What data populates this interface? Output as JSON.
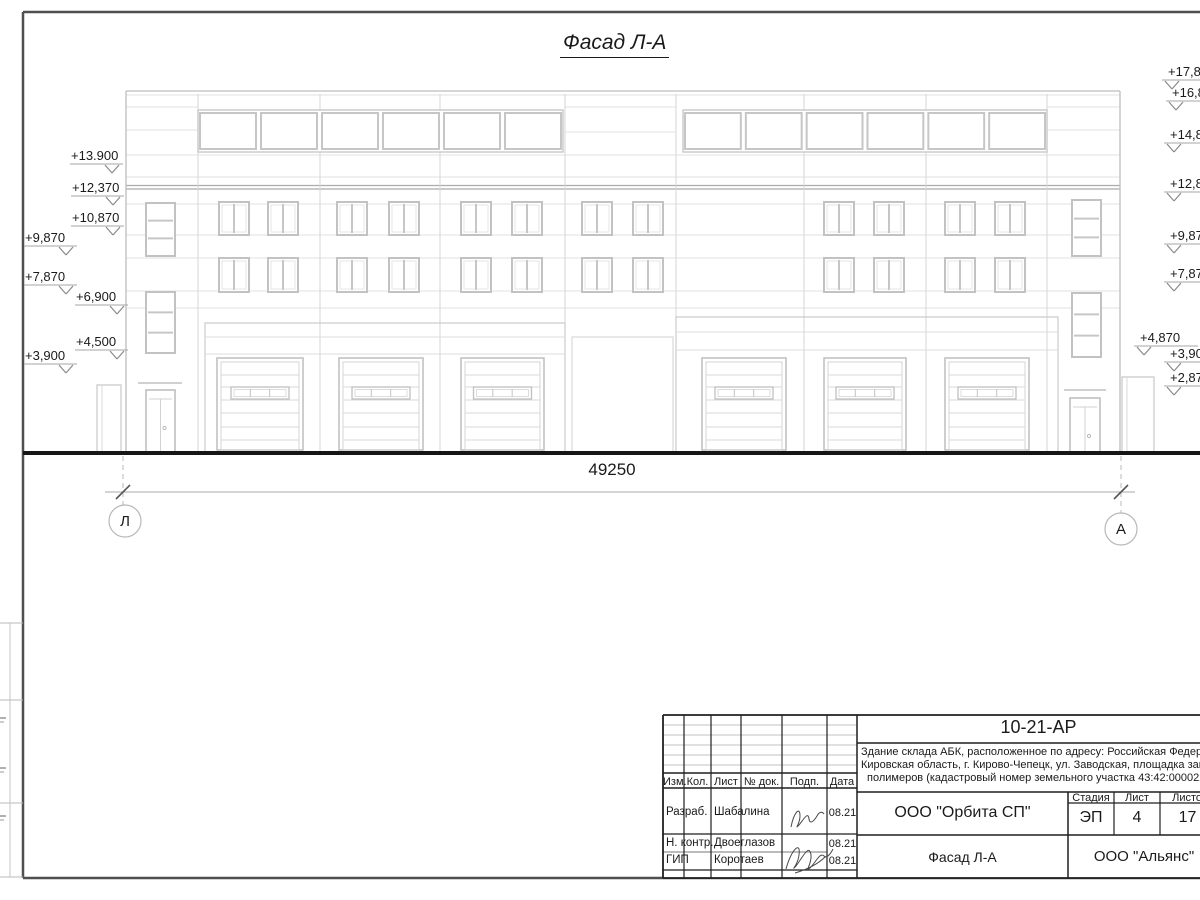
{
  "page": {
    "title": "Фасад Л-А"
  },
  "colors": {
    "draw_light": "#e2e2e2",
    "draw": "#cccccc",
    "draw_mid": "#bdbdbd",
    "slab": "#ababab",
    "symbol": "#8a8a8a",
    "ground": "#161616",
    "sheet_frame": "#4f4f4f",
    "title_block_ink": "#1f1f1f",
    "text": "#1a1a1a"
  },
  "dimension": {
    "label": "49250",
    "y": 492,
    "x1": 123,
    "x2": 1121
  },
  "axes": [
    {
      "label": "Л",
      "cx": 125,
      "cy": 521,
      "r": 16
    },
    {
      "label": "А",
      "cx": 1121,
      "cy": 529,
      "r": 16
    }
  ],
  "elevations": {
    "left": [
      {
        "label": "+13.900",
        "x": 71,
        "y": 156
      },
      {
        "label": "+12,370",
        "x": 72,
        "y": 188
      },
      {
        "label": "+10,870",
        "x": 72,
        "y": 218
      },
      {
        "label": "+9,870",
        "x": 25,
        "y": 238
      },
      {
        "label": "+7,870",
        "x": 25,
        "y": 277
      },
      {
        "label": "+6,900",
        "x": 76,
        "y": 297
      },
      {
        "label": "+4,500",
        "x": 76,
        "y": 342
      },
      {
        "label": "+3,900",
        "x": 25,
        "y": 356
      }
    ],
    "right": [
      {
        "label": "+17,870",
        "x": 1168,
        "y": 72
      },
      {
        "label": "+16,870",
        "x": 1172,
        "y": 93
      },
      {
        "label": "+14,870",
        "x": 1170,
        "y": 135
      },
      {
        "label": "+12,870",
        "x": 1170,
        "y": 184
      },
      {
        "label": "+9,870",
        "x": 1170,
        "y": 236
      },
      {
        "label": "+7,870",
        "x": 1170,
        "y": 274
      },
      {
        "label": "+4,870",
        "x": 1140,
        "y": 338
      },
      {
        "label": "+3,900",
        "x": 1170,
        "y": 354
      },
      {
        "label": "+2,870",
        "x": 1170,
        "y": 378
      }
    ]
  },
  "facade": {
    "frame": {
      "left": 23,
      "top": 12,
      "bottom": 878,
      "right": 1200
    },
    "ground_y": 453,
    "building": {
      "x1": 126,
      "x2": 1120,
      "top": 91
    },
    "band": {
      "top": 110,
      "bottom": 152,
      "win_top": 113,
      "win_bottom": 149,
      "groups": [
        {
          "x1": 198,
          "x2": 563,
          "n": 6
        },
        {
          "x1": 683,
          "x2": 1047,
          "n": 6
        }
      ]
    },
    "upper_full_lines": [
      95,
      155,
      177
    ],
    "upper_side_lines": [
      107,
      130
    ],
    "gap_lines": [
      107,
      132
    ],
    "slab": [
      185.5,
      189
    ],
    "bays": [
      198,
      320,
      440,
      565,
      676,
      804,
      926,
      1047
    ],
    "wall_lines": [
      204,
      235,
      258,
      291,
      308
    ],
    "win_rows": [
      [
        202,
        235
      ],
      [
        258,
        292
      ]
    ],
    "win_cols": [
      [
        219,
        249
      ],
      [
        268,
        298
      ],
      [
        337,
        367
      ],
      [
        389,
        419
      ],
      [
        461,
        491
      ],
      [
        512,
        542
      ],
      [
        582,
        612
      ],
      [
        633,
        663
      ],
      [
        824,
        854
      ],
      [
        874,
        904
      ],
      [
        945,
        975
      ],
      [
        995,
        1025
      ]
    ],
    "stair_windows": [
      {
        "x1": 146,
        "x2": 175,
        "wins": [
          [
            203,
            256
          ],
          [
            292,
            353
          ]
        ]
      },
      {
        "x1": 1072,
        "x2": 1101,
        "wins": [
          [
            200,
            256
          ],
          [
            293,
            357
          ]
        ]
      }
    ],
    "panels": [
      {
        "x1": 205,
        "x2": 565,
        "top": 323,
        "lines": [
          337,
          354
        ]
      },
      {
        "x1": 676,
        "x2": 1058,
        "top": 317,
        "lines": [
          332,
          350
        ]
      }
    ],
    "mid_inset": {
      "x1": 572,
      "x2": 673,
      "top": 337
    },
    "garages": {
      "top": 358,
      "bottom": 450,
      "cols": [
        [
          217,
          303
        ],
        [
          339,
          423
        ],
        [
          461,
          544
        ],
        [
          702,
          786
        ],
        [
          824,
          906
        ],
        [
          945,
          1029
        ]
      ],
      "panel_lines": [
        375,
        387,
        400,
        413,
        427,
        440
      ],
      "strip": {
        "y1": 387,
        "y2": 399,
        "width": 58,
        "panes": 3
      }
    },
    "doors": [
      {
        "x1": 146,
        "x2": 175,
        "top": 390,
        "canopy_y": 383,
        "canopy_x1": 138,
        "canopy_x2": 182
      },
      {
        "x1": 1070,
        "x2": 1100,
        "top": 398,
        "canopy_y": 390,
        "canopy_x1": 1064,
        "canopy_x2": 1106
      }
    ],
    "porches": [
      {
        "x1": 97,
        "x2": 121,
        "top": 385
      },
      {
        "x1": 1122,
        "x2": 1154,
        "top": 377
      }
    ],
    "left_strip_table": {
      "rows": [
        623,
        700,
        803,
        877
      ],
      "vx": 10,
      "ticks": [
        718,
        768,
        816
      ]
    }
  },
  "title_block": {
    "doc_number": "10-21-АР",
    "description_lines": [
      "Здание склада АБК, расположенное по адресу: Российская Федерация,",
      "Кировская область, г. Кирово-Чепецк, ул. Заводская, площадка завода",
      "полимеров (кадастровый номер земельного участка 43:42:000022:"
    ],
    "columns": [
      "Изм.",
      "Кол.",
      "Лист",
      "№ док.",
      "Подп.",
      "Дата"
    ],
    "rows": [
      {
        "role": "Разраб.",
        "name": "Шабалина",
        "date": "08.21"
      },
      {
        "role": "Н. контр.",
        "name": "Двоеглазов",
        "date": "08.21"
      },
      {
        "role": "ГИП",
        "name": "Коротаев",
        "date": "08.21"
      }
    ],
    "organization": "ООО \"Орбита СП\"",
    "stage_label": "Стадия",
    "sheet_label": "Лист",
    "sheets_label": "Листов",
    "stage": "ЭП",
    "sheet": "4",
    "sheets": "17",
    "view_title": "Фасад Л-А",
    "contractor": "ООО \"Альянс\""
  }
}
